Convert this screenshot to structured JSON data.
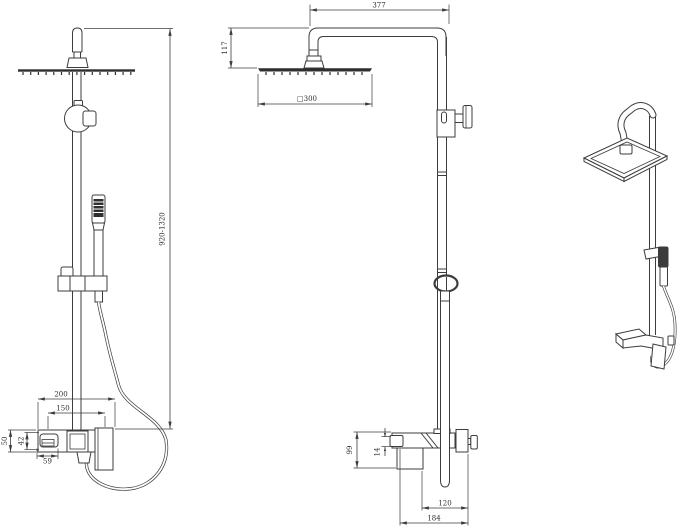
{
  "colors": {
    "background": "#ffffff",
    "line": "#3c3c3c",
    "dark_fill": "#2f2f2f",
    "text": "#2e2e2e"
  },
  "views": {
    "front": {
      "dims": {
        "height_range": "920-1320",
        "overall_width": "200",
        "inlet_spacing": "150",
        "body_height": "50",
        "inner_height": "42",
        "spout_width": "59"
      }
    },
    "side": {
      "dims": {
        "arm_reach": "377",
        "head_drop": "117",
        "head_size": "□300",
        "body_drop": "99",
        "spout_drop": "14",
        "wall_to_handle": "120",
        "wall_to_spout": "184"
      }
    }
  }
}
